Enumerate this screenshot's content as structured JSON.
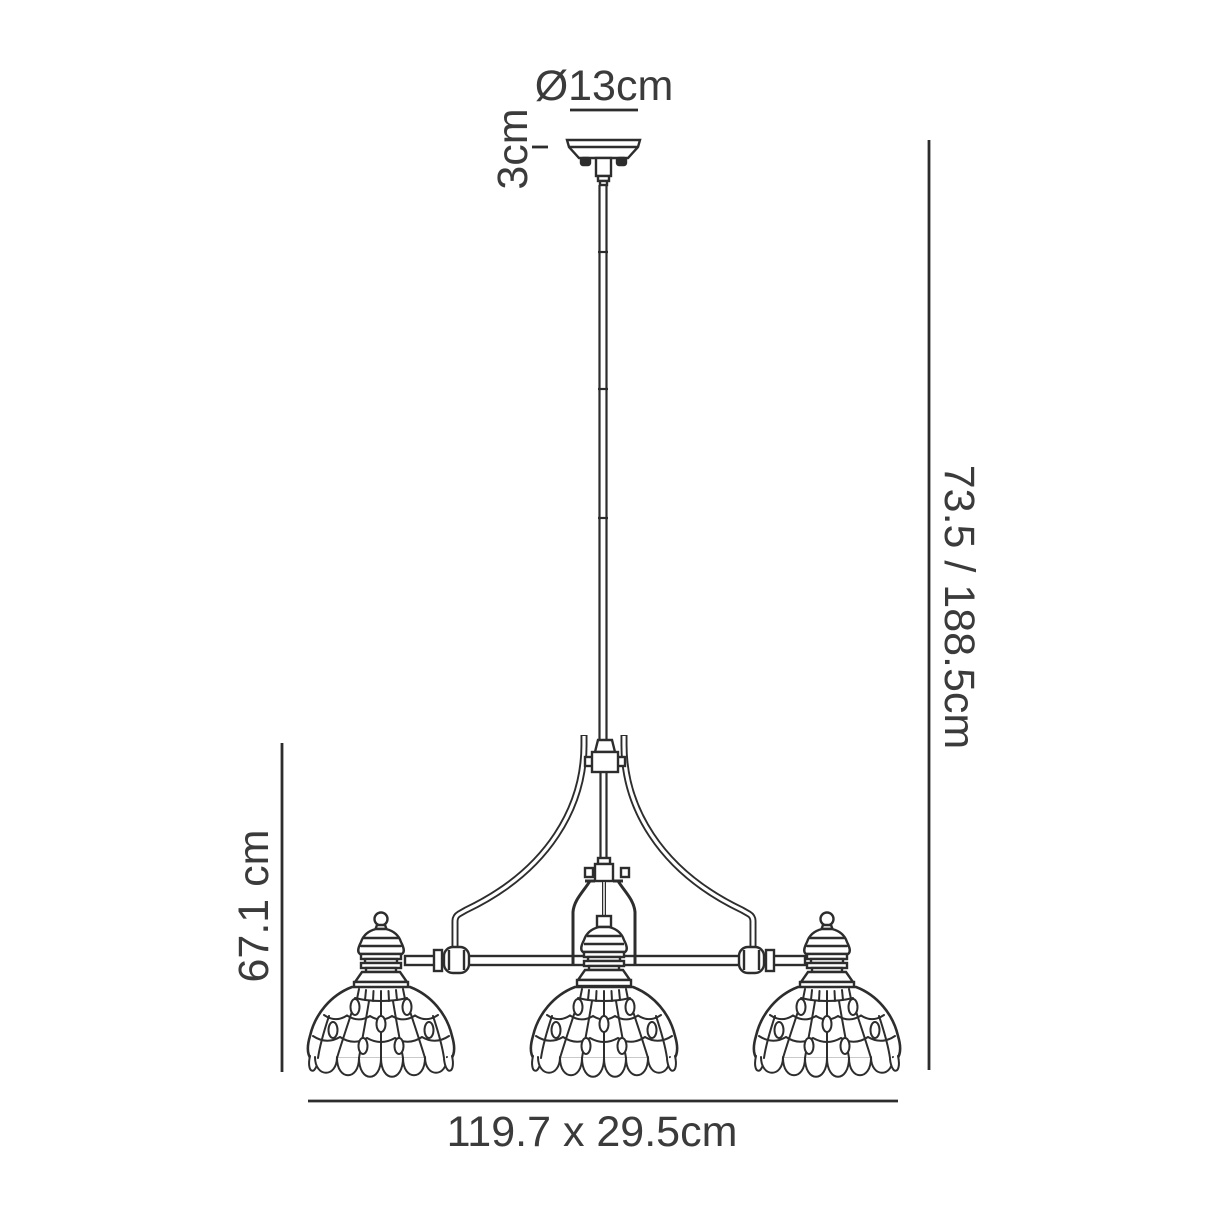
{
  "diagram": {
    "subject": "three-light pendant chandelier technical line drawing",
    "light_count": 3,
    "labels": {
      "canopy_diameter": "Ø13cm",
      "canopy_height": "3cm",
      "overall_height": "73.5 / 188.5cm",
      "body_height": "67.1 cm",
      "fixture_size": "119.7 x 29.5cm"
    },
    "colors": {
      "line": "#2d2d2d",
      "text": "#3b3b3b",
      "background": "#ffffff"
    }
  }
}
